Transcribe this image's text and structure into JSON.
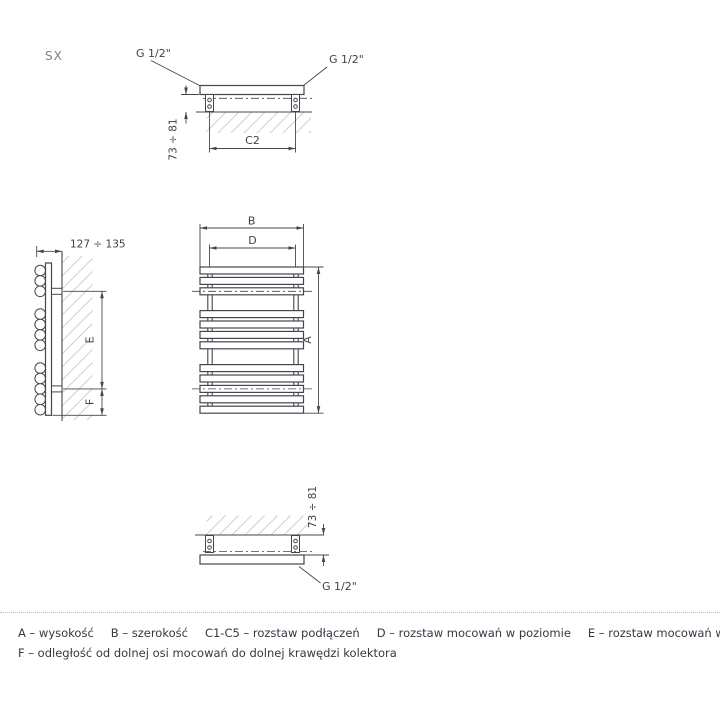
{
  "colors": {
    "line": "#43474d",
    "text": "#3d434b",
    "muted": "#7e838a",
    "hatch": "#cad0d6",
    "legend_text": "#323943",
    "divider": "#b9bdc2",
    "background": "#ffffff"
  },
  "variant_label": "SX",
  "top_view": {
    "thread_left": "G 1/2\"",
    "thread_right": "G 1/2\"",
    "depth_dim": "73 ÷ 81",
    "connection_spacing_dim": "C2"
  },
  "side_view": {
    "wall_distance_dim": "127 ÷ 135",
    "mount_vertical_dim": "E",
    "bottom_offset_dim": "F"
  },
  "front_view": {
    "width_dim": "B",
    "mount_horizontal_dim": "D",
    "height_dim": "A",
    "bar_groups": [
      3,
      4,
      5
    ]
  },
  "bottom_view": {
    "depth_dim": "73 ÷ 81",
    "thread": "G 1/2\""
  },
  "legend": {
    "items": [
      "A – wysokość",
      "B – szerokość",
      "C1-C5 – rozstaw podłączeń",
      "D – rozstaw mocowań w poziomie",
      "E – rozstaw mocowań w pionie",
      "F –  odległość od dolnej osi mocowań do dolnej krawędzi kolektora"
    ]
  }
}
